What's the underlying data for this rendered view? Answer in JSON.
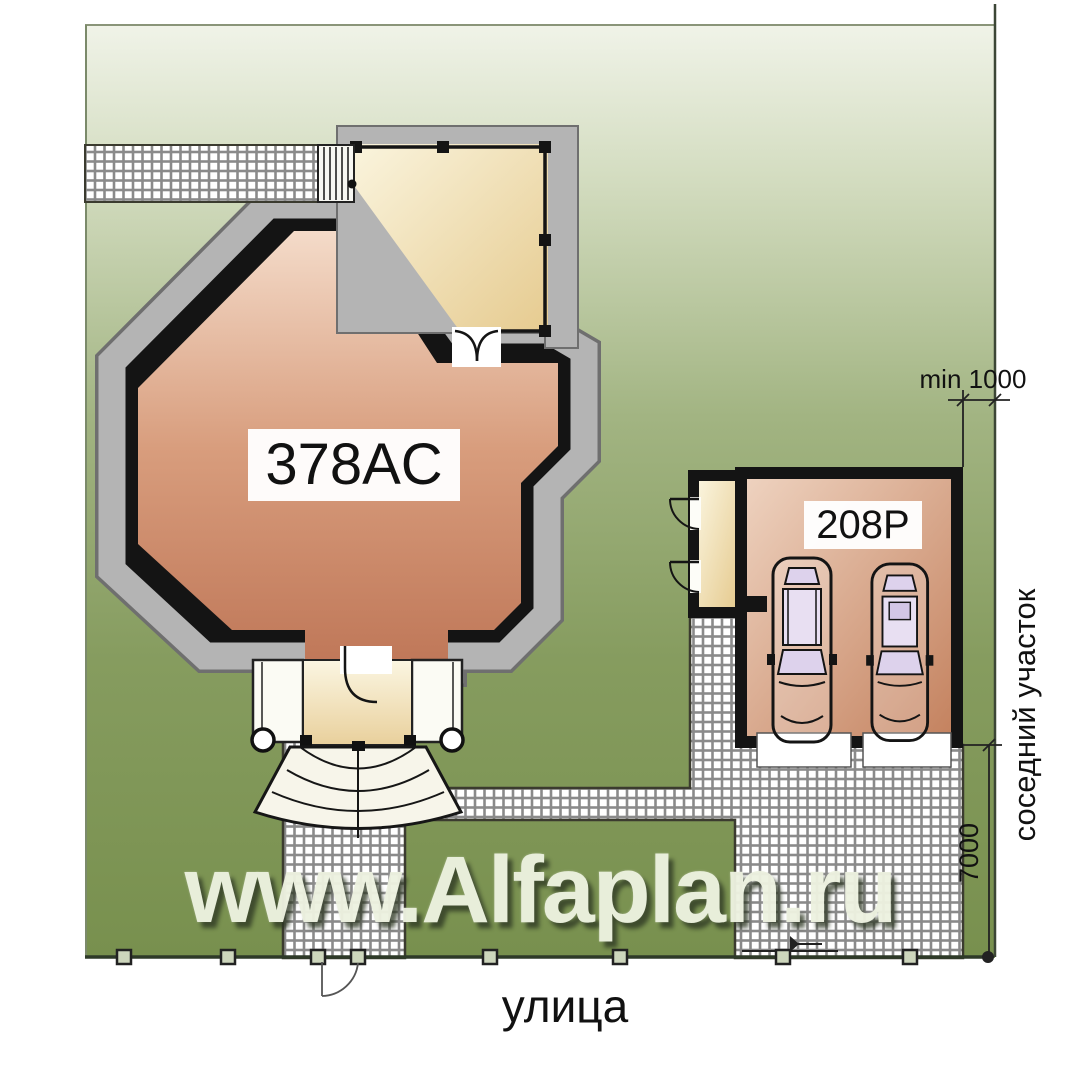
{
  "site_plan": {
    "house": {
      "label": "378AC"
    },
    "garage": {
      "label": "208P"
    },
    "street_label": "улица",
    "neighbor_label": "соседний участок",
    "dimensions": {
      "min_offset": "min 1000",
      "side_length": "7000"
    },
    "watermark": "www.Alfaplan.ru",
    "colors": {
      "lawn_dark": "#78904e",
      "lawn_light": "#eef2e4",
      "house_fill": "#d59a7b",
      "terrace_fill": "#f0dfae",
      "paving_gray": "#8a8a8a",
      "wall_black": "#141414",
      "roof_band_gray": "#b4b4b4"
    }
  }
}
